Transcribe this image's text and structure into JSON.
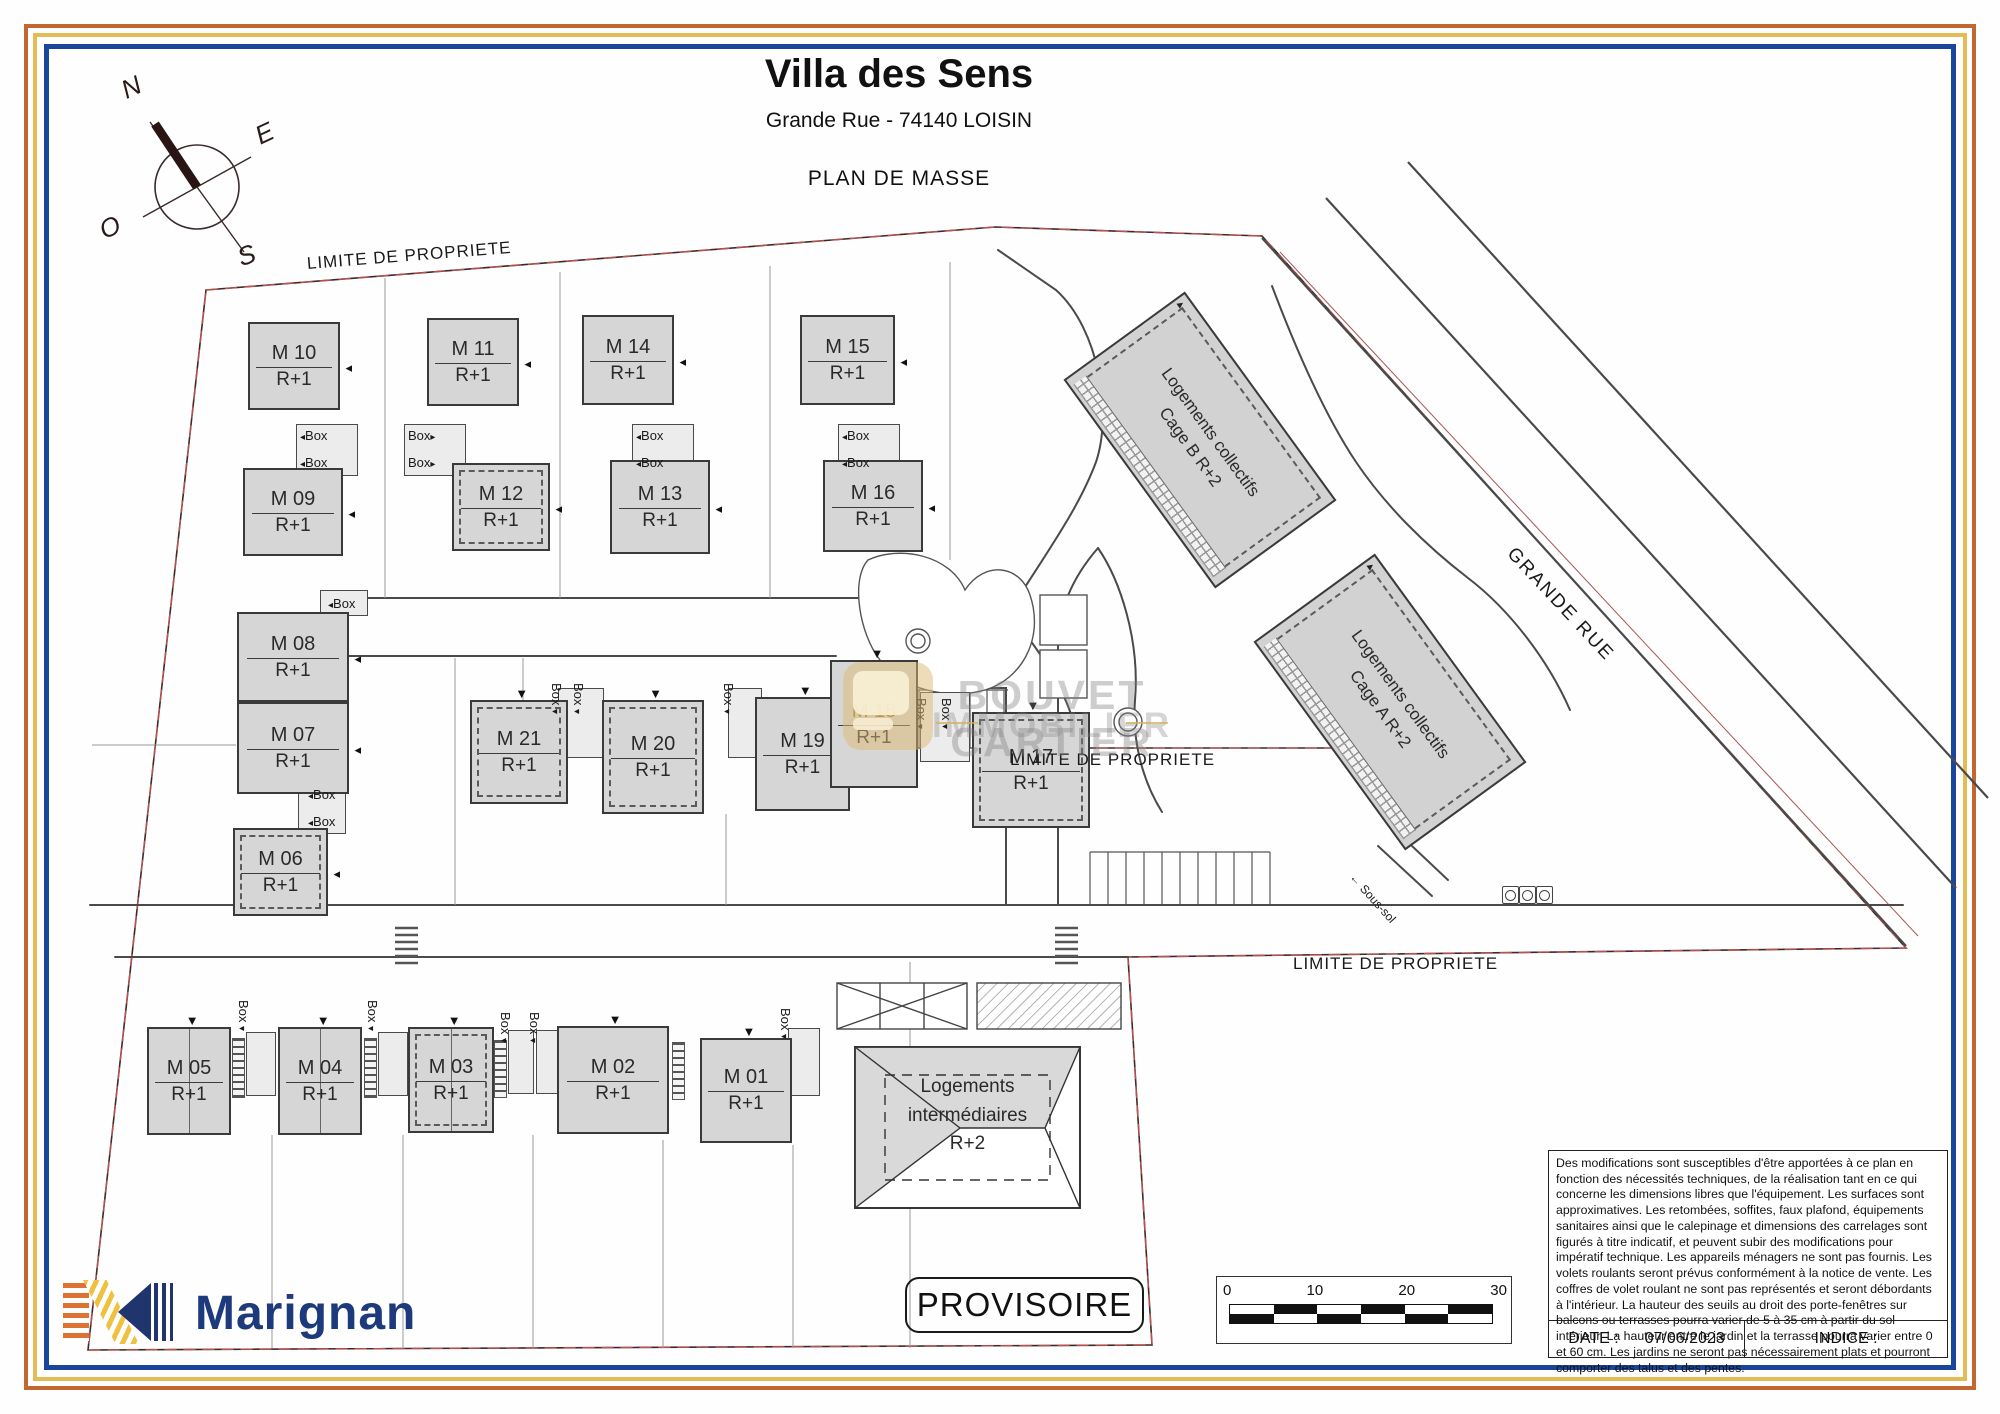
{
  "title": {
    "main": "Villa des Sens",
    "address": "Grande Rue - 74140 LOISIN",
    "plan": "PLAN DE MASSE"
  },
  "compass": {
    "letters": [
      {
        "t": "N",
        "x": 122,
        "y": 72,
        "r": -25
      },
      {
        "t": "E",
        "x": 256,
        "y": 118,
        "r": -25
      },
      {
        "t": "O",
        "x": 100,
        "y": 212,
        "r": -25
      },
      {
        "t": "S",
        "x": 238,
        "y": 240,
        "r": -20
      }
    ]
  },
  "area_labels": [
    {
      "text": "LIMITE DE PROPRIETE",
      "x": 307,
      "y": 254,
      "r": -4.5,
      "fs": 17,
      "ls": 1
    },
    {
      "text": "LIMITE DE PROPRIETE",
      "x": 1010,
      "y": 750,
      "r": 0,
      "fs": 17,
      "ls": 1
    },
    {
      "text": "LIMITE DE PROPRIETE",
      "x": 1293,
      "y": 954,
      "r": 0,
      "fs": 17,
      "ls": 1
    },
    {
      "text": "GRANDE RUE",
      "x": 1510,
      "y": 540,
      "r": 47,
      "fs": 19,
      "ls": 2
    },
    {
      "text": "← Sous-sol",
      "x": 1352,
      "y": 868,
      "r": 48,
      "fs": 12,
      "ls": 0
    }
  ],
  "houses": [
    {
      "id": "m10",
      "name": "M 10",
      "floor": "R+1",
      "x": 248,
      "y": 322,
      "w": 92,
      "h": 88,
      "dashed": false,
      "gold": false,
      "split": false,
      "marker": "right"
    },
    {
      "id": "m11",
      "name": "M 11",
      "floor": "R+1",
      "x": 427,
      "y": 318,
      "w": 92,
      "h": 88,
      "dashed": false,
      "gold": false,
      "split": false,
      "marker": "right"
    },
    {
      "id": "m14",
      "name": "M 14",
      "floor": "R+1",
      "x": 582,
      "y": 315,
      "w": 92,
      "h": 90,
      "dashed": false,
      "gold": false,
      "split": false,
      "marker": "right"
    },
    {
      "id": "m15",
      "name": "M 15",
      "floor": "R+1",
      "x": 800,
      "y": 315,
      "w": 95,
      "h": 90,
      "dashed": false,
      "gold": false,
      "split": false,
      "marker": "right"
    },
    {
      "id": "m09",
      "name": "M 09",
      "floor": "R+1",
      "x": 243,
      "y": 468,
      "w": 100,
      "h": 88,
      "dashed": false,
      "gold": false,
      "split": false,
      "marker": "right"
    },
    {
      "id": "m12",
      "name": "M 12",
      "floor": "R+1",
      "x": 452,
      "y": 463,
      "w": 98,
      "h": 88,
      "dashed": true,
      "gold": false,
      "split": false,
      "marker": "right"
    },
    {
      "id": "m13",
      "name": "M 13",
      "floor": "R+1",
      "x": 610,
      "y": 460,
      "w": 100,
      "h": 94,
      "dashed": false,
      "gold": false,
      "split": false,
      "marker": "right"
    },
    {
      "id": "m16",
      "name": "M 16",
      "floor": "R+1",
      "x": 823,
      "y": 460,
      "w": 100,
      "h": 92,
      "dashed": false,
      "gold": false,
      "split": false,
      "marker": "right"
    },
    {
      "id": "m08",
      "name": "M 08",
      "floor": "R+1",
      "x": 237,
      "y": 612,
      "w": 112,
      "h": 90,
      "dashed": false,
      "gold": false,
      "split": false,
      "marker": "right"
    },
    {
      "id": "m07",
      "name": "M 07",
      "floor": "R+1",
      "x": 237,
      "y": 702,
      "w": 112,
      "h": 92,
      "dashed": false,
      "gold": false,
      "split": false,
      "marker": "right"
    },
    {
      "id": "m06",
      "name": "M 06",
      "floor": "R+1",
      "x": 233,
      "y": 828,
      "w": 95,
      "h": 88,
      "dashed": true,
      "gold": false,
      "split": false,
      "marker": "right"
    },
    {
      "id": "m21",
      "name": "M 21",
      "floor": "R+1",
      "x": 470,
      "y": 700,
      "w": 98,
      "h": 104,
      "dashed": true,
      "gold": false,
      "split": false,
      "marker": "top"
    },
    {
      "id": "m20",
      "name": "M 20",
      "floor": "R+1",
      "x": 602,
      "y": 700,
      "w": 102,
      "h": 114,
      "dashed": true,
      "gold": false,
      "split": false,
      "marker": "top"
    },
    {
      "id": "m19",
      "name": "M 19",
      "floor": "R+1",
      "x": 755,
      "y": 697,
      "w": 95,
      "h": 114,
      "dashed": false,
      "gold": false,
      "split": false,
      "marker": "top"
    },
    {
      "id": "m18",
      "name": "M 18",
      "floor": "R+1",
      "x": 830,
      "y": 660,
      "w": 88,
      "h": 128,
      "dashed": false,
      "gold": true,
      "split": false,
      "marker": "top"
    },
    {
      "id": "m17",
      "name": "M 17",
      "floor": "R+1",
      "x": 972,
      "y": 712,
      "w": 118,
      "h": 116,
      "dashed": true,
      "gold": false,
      "split": false,
      "marker": "top"
    },
    {
      "id": "m05",
      "name": "M 05",
      "floor": "R+1",
      "x": 147,
      "y": 1027,
      "w": 84,
      "h": 108,
      "dashed": false,
      "gold": false,
      "split": true,
      "marker": "top"
    },
    {
      "id": "m04",
      "name": "M 04",
      "floor": "R+1",
      "x": 278,
      "y": 1027,
      "w": 84,
      "h": 108,
      "dashed": false,
      "gold": false,
      "split": true,
      "marker": "top"
    },
    {
      "id": "m03",
      "name": "M 03",
      "floor": "R+1",
      "x": 408,
      "y": 1027,
      "w": 86,
      "h": 106,
      "dashed": true,
      "gold": false,
      "split": true,
      "marker": "top"
    },
    {
      "id": "m02",
      "name": "M 02",
      "floor": "R+1",
      "x": 557,
      "y": 1026,
      "w": 112,
      "h": 108,
      "dashed": false,
      "gold": false,
      "split": false,
      "marker": "top"
    },
    {
      "id": "m01",
      "name": "M 01",
      "floor": "R+1",
      "x": 700,
      "y": 1038,
      "w": 92,
      "h": 105,
      "dashed": false,
      "gold": false,
      "split": false,
      "marker": "top"
    }
  ],
  "collectives": [
    {
      "id": "cage-b",
      "line1": "Logements collectifs",
      "line2": "Cage B R+2",
      "cx": 1200,
      "cy": 440,
      "w": 150,
      "h": 258,
      "rot": -36
    },
    {
      "id": "cage-a",
      "line1": "Logements collectifs",
      "line2": "Cage A R+2",
      "cx": 1390,
      "cy": 702,
      "w": 150,
      "h": 258,
      "rot": -36
    }
  ],
  "intermediate": {
    "lines": [
      "Logements",
      "intermédiaires",
      "R+2"
    ],
    "x": 855,
    "y": 1047,
    "w": 225,
    "h": 161
  },
  "box_labels": [
    {
      "x": 300,
      "y": 428,
      "r": 0,
      "arrow": "left"
    },
    {
      "x": 300,
      "y": 455,
      "r": 0,
      "arrow": "left"
    },
    {
      "x": 408,
      "y": 428,
      "r": 0,
      "arrow": "right"
    },
    {
      "x": 408,
      "y": 455,
      "r": 0,
      "arrow": "right"
    },
    {
      "x": 636,
      "y": 428,
      "r": 0,
      "arrow": "left"
    },
    {
      "x": 636,
      "y": 455,
      "r": 0,
      "arrow": "left"
    },
    {
      "x": 842,
      "y": 428,
      "r": 0,
      "arrow": "left"
    },
    {
      "x": 842,
      "y": 455,
      "r": 0,
      "arrow": "left"
    },
    {
      "x": 328,
      "y": 596,
      "r": 0,
      "arrow": "left"
    },
    {
      "x": 308,
      "y": 787,
      "r": 0,
      "arrow": "left"
    },
    {
      "x": 308,
      "y": 814,
      "r": 0,
      "arrow": "left"
    },
    {
      "x": 564,
      "y": 683,
      "r": 90,
      "arrow": "down"
    },
    {
      "x": 586,
      "y": 683,
      "r": 90,
      "arrow": "down"
    },
    {
      "x": 736,
      "y": 683,
      "r": 90,
      "arrow": "down"
    },
    {
      "x": 929,
      "y": 698,
      "r": 90,
      "arrow": "down"
    },
    {
      "x": 954,
      "y": 698,
      "r": 90,
      "arrow": "down"
    },
    {
      "x": 251,
      "y": 1000,
      "r": 90,
      "arrow": "down"
    },
    {
      "x": 380,
      "y": 1000,
      "r": 90,
      "arrow": "down"
    },
    {
      "x": 513,
      "y": 1012,
      "r": 90,
      "arrow": "down"
    },
    {
      "x": 542,
      "y": 1012,
      "r": 90,
      "arrow": "down"
    },
    {
      "x": 793,
      "y": 1008,
      "r": 90,
      "arrow": "down"
    }
  ],
  "box_text": "Box",
  "watermark": {
    "line1": "BOUVET CARTIER",
    "line2": "IMMOBILIER"
  },
  "footer": {
    "brand": "Marignan",
    "stamp": "PROVISOIRE",
    "scale_ticks": [
      "0",
      "10",
      "20",
      "30"
    ],
    "disclaimer": "Des modifications sont susceptibles d'être apportées à ce plan en fonction des nécessités techniques, de la réalisation tant en ce qui concerne les dimensions libres que l'équipement. Les surfaces sont approximatives. Les retombées, soffites, faux plafond, équipements sanitaires ainsi que le calepinage et dimensions des carrelages sont figurés à titre indicatif, et peuvent subir des modifications pour impératif technique. Les appareils ménagers ne sont pas fournis. Les volets roulants seront prévus conformément à la notice de vente. Les coffres de volet roulant ne sont pas représentés et seront débordants à l'intérieur. La hauteur des seuils au droit des porte-fenêtres sur balcons ou terrasses pourra varier de 5 à 35 cm à partir du sol intérieur. La hauteur entre le jardin et la terrasse pourra varier entre 0 et 60 cm. Les jardins ne seront pas nécessairement plats et pourront comporter des talus et des pentes.",
    "date_label": "DATE :",
    "date_value": "07/06/2023",
    "indice_label": "INDICE :"
  },
  "colors": {
    "frame_orange": "#c2672f",
    "frame_gold": "#e2bd55",
    "frame_blue": "#1b459c",
    "boundary_red": "#c0504d",
    "house_fill": "#d6d6d6",
    "brand_blue": "#1d3a7d",
    "watermark_gold": "#d4af5a"
  }
}
